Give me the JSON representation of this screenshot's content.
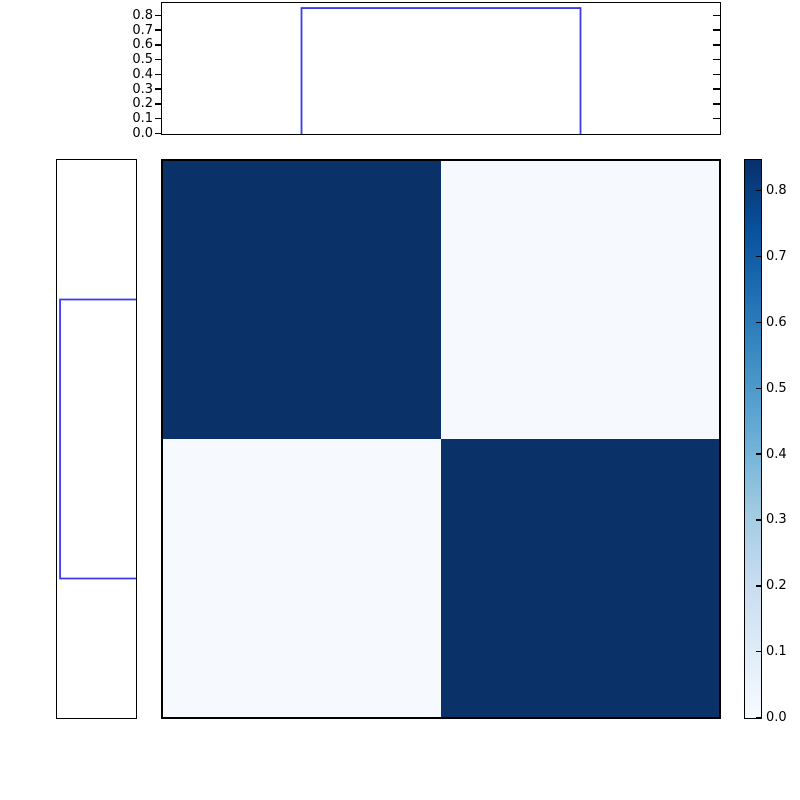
{
  "figure": {
    "background": "#ffffff",
    "width": 800,
    "height": 800,
    "description": "2x2 checkerboard heatmap with step-function marginal plots on top and left, and a Blues colorbar on the right"
  },
  "colors": {
    "step_line": "#3a3af0",
    "axis": "#000000",
    "heat_high": "#0a3168",
    "heat_low": "#f6f9fd"
  },
  "chart_data": [
    {
      "id": "top_marginal",
      "type": "line",
      "subtype": "step",
      "orientation": "horizontal",
      "title": "",
      "xlabel": "",
      "ylabel": "",
      "ylim": [
        0.0,
        0.88
      ],
      "ytick_values": [
        0.8,
        0.7,
        0.6,
        0.5,
        0.4,
        0.3,
        0.2,
        0.1,
        0.0
      ],
      "tick_labels": [
        "0.8",
        "0.7",
        "0.6",
        "0.5",
        "0.4",
        "0.3",
        "0.2",
        "0.1",
        "0.0"
      ],
      "right_tick_values": [
        0.8,
        0.7,
        0.6,
        0.5,
        0.4,
        0.3,
        0.2,
        0.1
      ],
      "step": {
        "rise_frac": 0.25,
        "fall_frac": 0.75,
        "value": 0.846
      },
      "line_color": "#3a3af0",
      "grid": false
    },
    {
      "id": "left_marginal",
      "type": "line",
      "subtype": "step",
      "orientation": "vertical",
      "title": "",
      "value_axis_lim": [
        0.0,
        0.88
      ],
      "value_axis_direction": "increases-leftward",
      "step": {
        "rise_frac": 0.25,
        "fall_frac": 0.75,
        "value": 0.846
      },
      "line_color": "#3a3af0",
      "grid": false
    },
    {
      "id": "heatmap",
      "type": "heatmap",
      "title": "",
      "rows": 2,
      "cols": 2,
      "matrix": [
        [
          0.846,
          0.02
        ],
        [
          0.02,
          0.846
        ]
      ],
      "cell_colors": [
        [
          "#0a3168",
          "#f6f9fd"
        ],
        [
          "#f6f9fd",
          "#0a3168"
        ]
      ],
      "colormap": "Blues",
      "vmin": 0.0,
      "vmax": 0.846
    },
    {
      "id": "colorbar",
      "type": "colorbar",
      "orientation": "vertical",
      "vmin": 0.0,
      "vmax": 0.846,
      "tick_values": [
        0.8,
        0.7,
        0.6,
        0.5,
        0.4,
        0.3,
        0.2,
        0.1,
        0.0
      ],
      "tick_labels": [
        "0.8",
        "0.7",
        "0.6",
        "0.5",
        "0.4",
        "0.3",
        "0.2",
        "0.1",
        "0.0"
      ],
      "colormap": "Blues",
      "gradient_stops": [
        {
          "t": 0.0,
          "color": "#f7fbff"
        },
        {
          "t": 0.125,
          "color": "#deebf7"
        },
        {
          "t": 0.25,
          "color": "#c6dbef"
        },
        {
          "t": 0.375,
          "color": "#9ecae1"
        },
        {
          "t": 0.5,
          "color": "#6baed6"
        },
        {
          "t": 0.625,
          "color": "#4292c6"
        },
        {
          "t": 0.75,
          "color": "#2171b5"
        },
        {
          "t": 0.875,
          "color": "#08519c"
        },
        {
          "t": 1.0,
          "color": "#08306b"
        }
      ]
    }
  ]
}
